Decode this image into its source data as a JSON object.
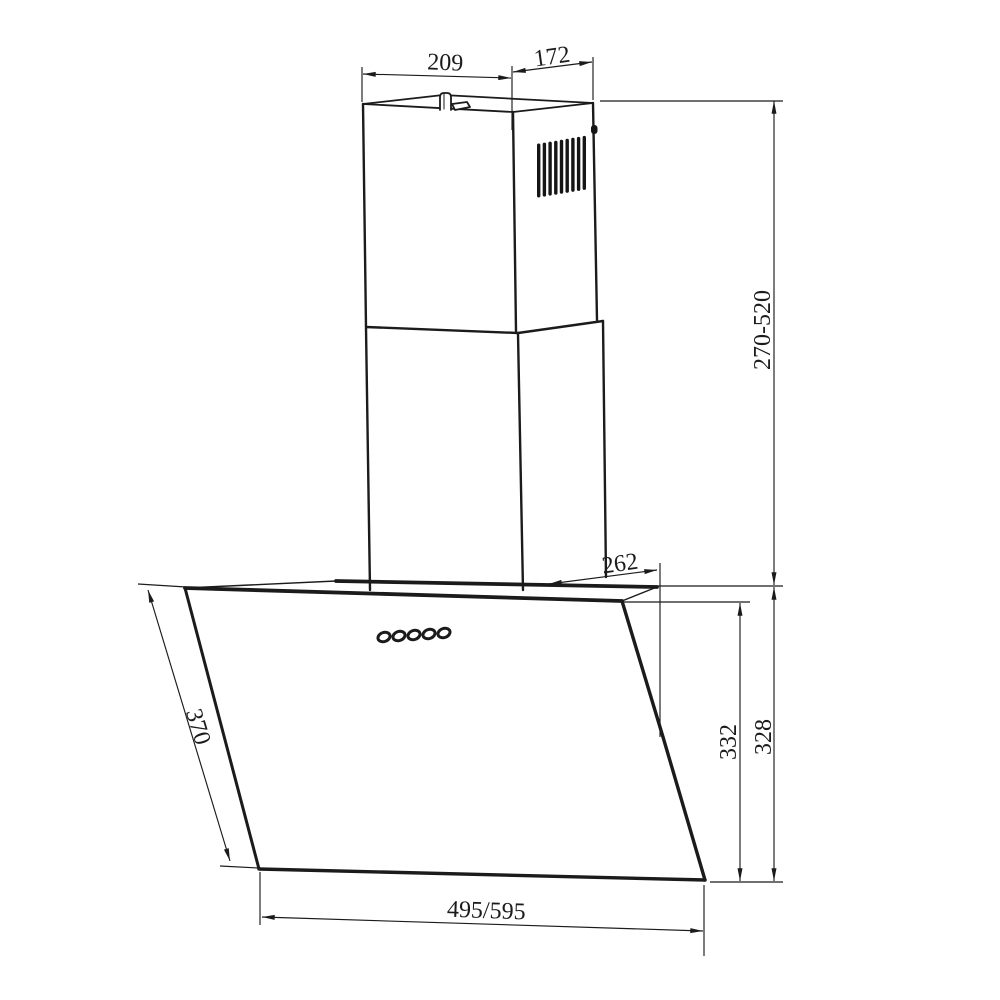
{
  "page": {
    "background": "#ffffff"
  },
  "drawing": {
    "type": "technical-dimension-drawing",
    "subject": "wall-mounted angled range hood with telescopic chimney",
    "line_color": "#1b1b1b",
    "control_buttons_count": 5,
    "vent_slats_count": 9,
    "labels": {
      "chimney_top_width": "209",
      "chimney_top_depth": "172",
      "chimney_height_range": "270-520",
      "canopy_top_depth": "262",
      "glass_front_height": "332",
      "body_rear_height": "328",
      "glass_slant_length": "370",
      "hood_width_options": "495/595"
    }
  }
}
